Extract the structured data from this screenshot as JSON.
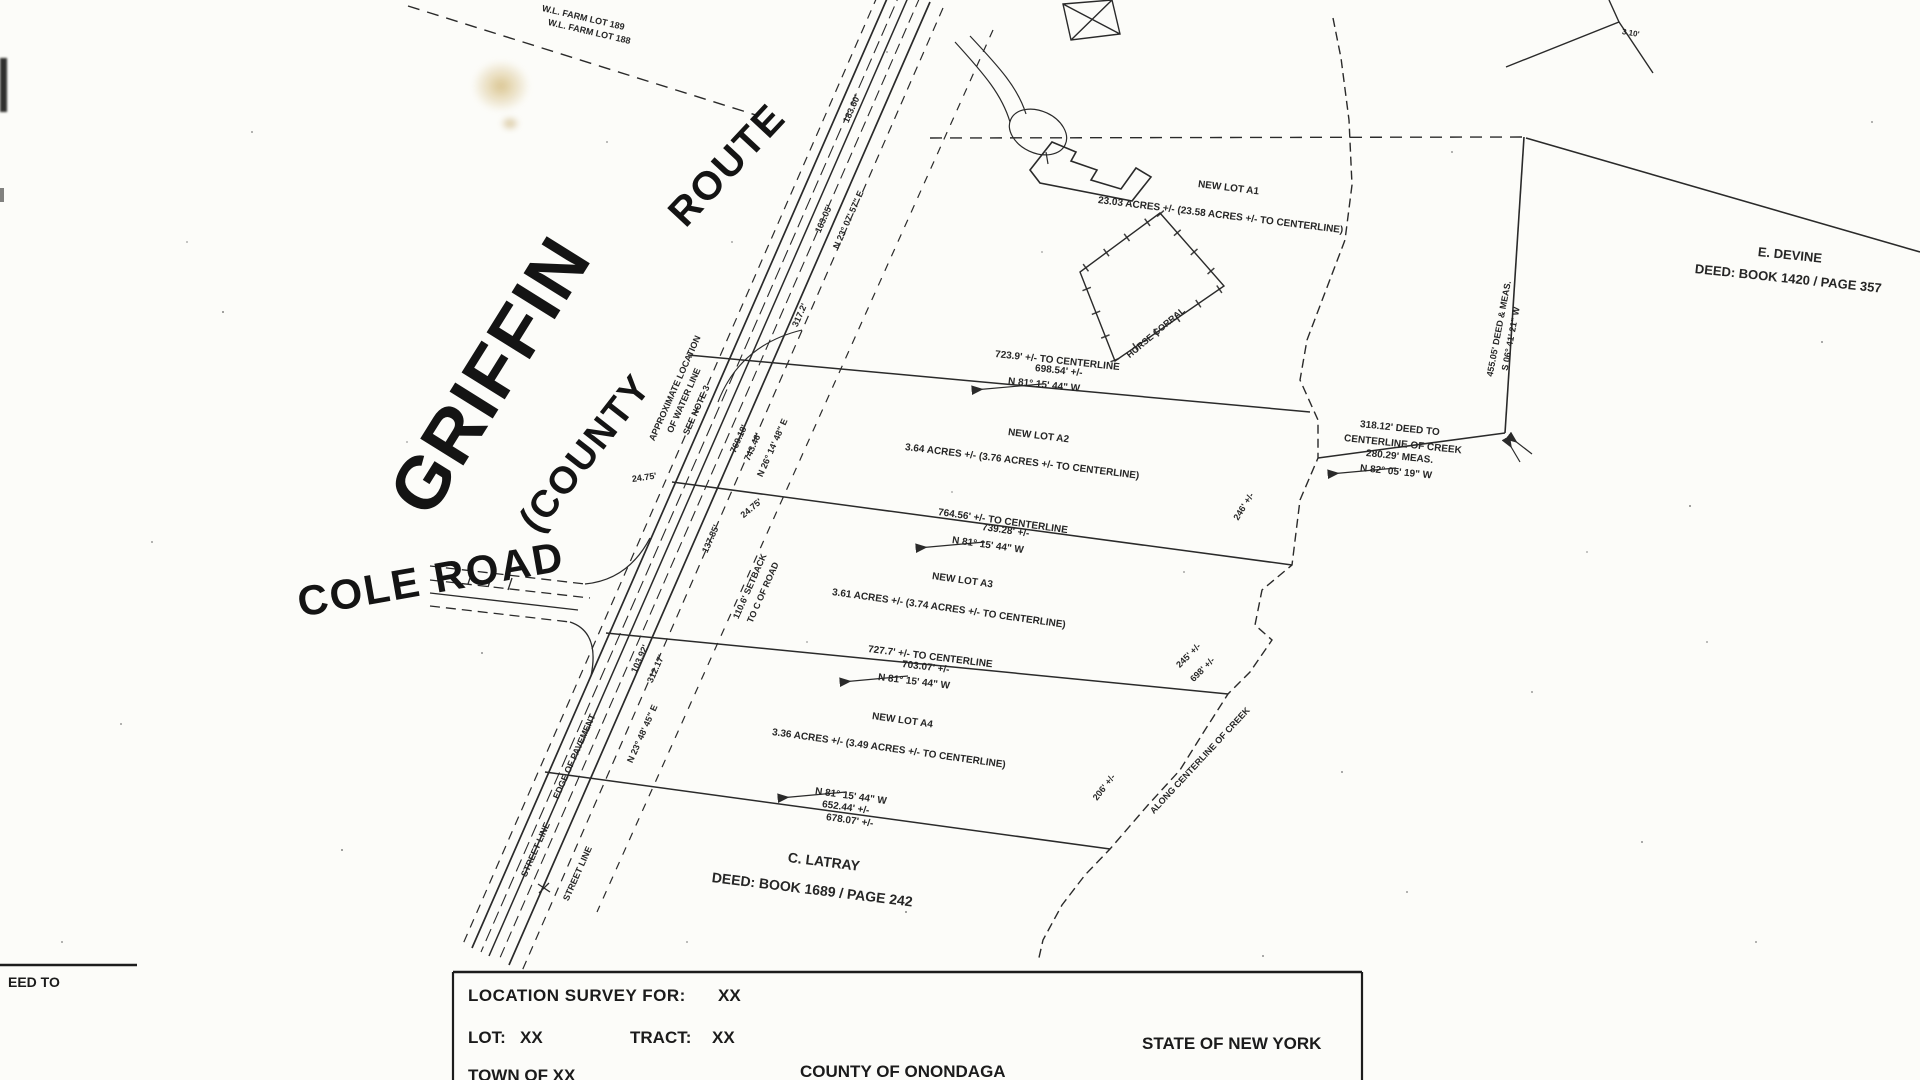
{
  "map": {
    "names": {
      "griffin": "GRIFFIN",
      "county": "(COUNTY",
      "route": "ROUTE",
      "cole": "COLE ROAD"
    },
    "farm": {
      "l1": "W.L. FARM LOT 189",
      "l2": "W.L. FARM LOT 188"
    },
    "lots": [
      {
        "name": "NEW LOT A1",
        "acreage": "23.03 ACRES +/- (23.58 ACRES +/- TO CENTERLINE)"
      },
      {
        "name": "NEW LOT A2",
        "acreage": "3.64 ACRES +/- (3.76 ACRES +/- TO CENTERLINE)"
      },
      {
        "name": "NEW LOT A3",
        "acreage": "3.61 ACRES +/- (3.74 ACRES +/- TO CENTERLINE)"
      },
      {
        "name": "NEW LOT A4",
        "acreage": "3.36 ACRES +/- (3.49 ACRES +/- TO CENTERLINE)"
      }
    ],
    "dims": [
      {
        "l1": "723.9' +/- TO CENTERLINE",
        "l2": "698.54' +/-",
        "l3": "N 81° 15' 44\" W"
      },
      {
        "l1": "764.56' +/- TO CENTERLINE",
        "l2": "739.28' +/-",
        "l3": "N 81° 15' 44\" W"
      },
      {
        "l1": "727.7' +/- TO CENTERLINE",
        "l2": "703.07' +/-",
        "l3": "N 81° 15' 44\" W"
      },
      {
        "l1": "N 81° 15' 44\" W",
        "l2": "652.44' +/-",
        "l3": "678.07' +/-"
      }
    ],
    "creek_dim": {
      "l1": "318.12' DEED TO",
      "l2": "CENTERLINE OF CREEK",
      "l3": "280.29' MEAS.",
      "l4": "N 82° 05' 19\" W"
    },
    "east": {
      "l1": "455.05' DEED & MEAS.",
      "l2": "S 06° 41' 21\" W"
    },
    "neighbors": [
      {
        "name": "E. DEVINE",
        "deed": "DEED:  BOOK 1420 / PAGE 357"
      },
      {
        "name": "C. LATRAY",
        "deed": "DEED:  BOOK 1689 / PAGE 242"
      }
    ],
    "creek": {
      "d246": "246' +/-",
      "d245": "245' +/-",
      "d698": "698' +/-",
      "along": "ALONG CENTERLINE OF CREEK",
      "d206": "206' +/-"
    },
    "corral": "HORSE CORRAL",
    "corner": "3.10'",
    "road": {
      "d183": "183.60'",
      "d163": "163.05'",
      "b23": "N 23° 07' 57\" E",
      "d317": "317.2'",
      "d769": "769.18'",
      "d743": "743.46'",
      "b26": "N 26° 14' 48\" E",
      "w1": "APPROXIMATE LOCATION",
      "w2": "OF WATER LINE",
      "w3": "SEE NOTE 3",
      "d2475a": "24.75'",
      "d2475b": "24.75'",
      "d137": "137.85'",
      "sb1": "110.6' SETBACK",
      "sb2": "TO C OF ROAD",
      "d103": "103.92'",
      "d312": "312.17'",
      "b2348": "N 23° 48' 45\" E",
      "edge": "EDGE OF PAVEMENT",
      "street1": "STREET LINE",
      "street2": "STREET LINE"
    }
  },
  "title_block": {
    "deed_to": "EED TO",
    "loc_label": "LOCATION SURVEY FOR:",
    "loc_val": "XX",
    "lot_label": "LOT:",
    "lot_val": "XX",
    "tract_label": "TRACT:",
    "tract_val": "XX",
    "town": "TOWN OF XX",
    "county": "COUNTY OF ONONDAGA",
    "state": "STATE OF NEW YORK"
  },
  "colors": {
    "ink": "#2a2a2a",
    "paper": "#fcfcf9",
    "stain": "#c09a3e"
  }
}
